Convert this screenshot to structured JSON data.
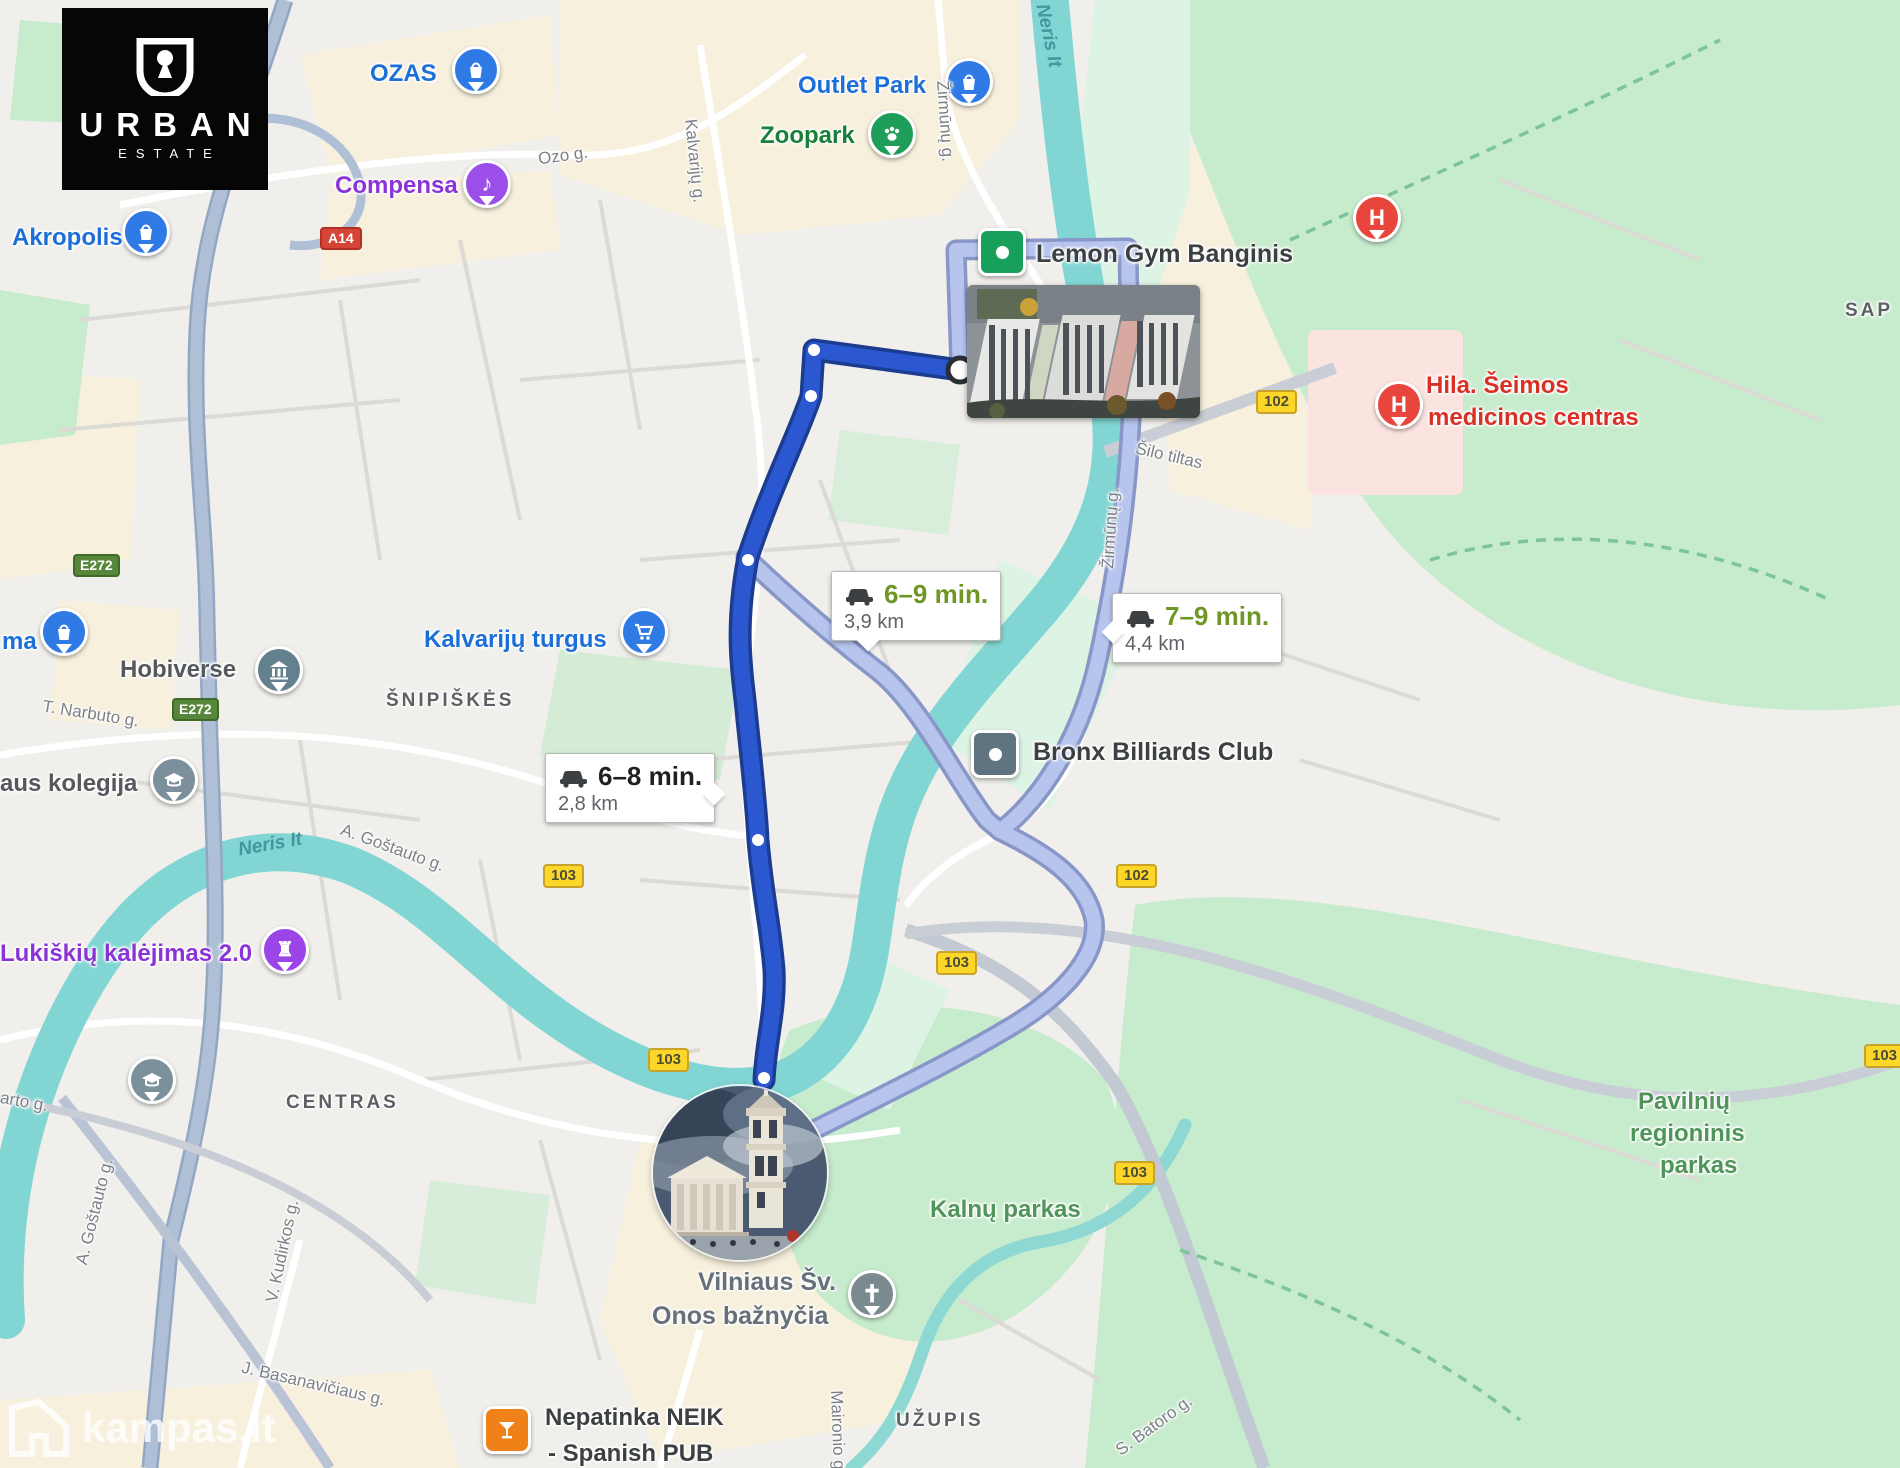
{
  "logo": {
    "brand": "URBAN",
    "sub": "ESTATE"
  },
  "watermark": {
    "text": "kampas.lt"
  },
  "pois": {
    "ozas": {
      "label": "OZAS"
    },
    "outlet": {
      "label": "Outlet Park"
    },
    "zoopark": {
      "label": "Zoopark"
    },
    "compensa": {
      "label": "Compensa"
    },
    "akropolis": {
      "label": "Akropolis"
    },
    "ma": {
      "label": "ma"
    },
    "kalvariju_turgus": {
      "label": "Kalvarijų turgus"
    },
    "hobiverse": {
      "label": "Hobiverse"
    },
    "kolegija": {
      "label": "aus kolegija"
    },
    "lukiskiu": {
      "label": "Lukiškių kalėjimas 2.0"
    },
    "lemon": {
      "label": "Lemon Gym Banginis"
    },
    "bronx": {
      "label": "Bronx Billiards Club"
    },
    "hila": {
      "line1": "Hila. Šeimos",
      "line2": "medicinos centras"
    },
    "onos": {
      "line1": "Vilniaus Šv.",
      "line2": "Onos bažnyčia"
    },
    "pub": {
      "line1": "Nepatinka NEIK",
      "line2": "- Spanish PUB"
    }
  },
  "districts": {
    "snipiskes": "ŠNIPIŠKĖS",
    "centras": "CENTRAS",
    "uzupis": "UŽUPIS",
    "sap": "SAP"
  },
  "parks": {
    "kalnu": "Kalnų parkas",
    "pavilniu1": "Pavilnių",
    "pavilniu2": "regioninis",
    "pavilniu3": "parkas"
  },
  "roads": {
    "ozo": "Ozo g.",
    "kalvariju": "Kalvarijų g.",
    "zirmunu_top": "Žirmūnų g.",
    "zirmunu_mid": "Žirmūnų g.",
    "neris_top": "Neris It",
    "neris_left": "Neris It",
    "silo": "Šilo tiltas",
    "narbuto": "T. Narbuto g.",
    "gostauto_diag": "A. Goštauto g.",
    "gostauto_vert": "A. Goštauto g.",
    "gostauto_frag": "arto g.",
    "kudirkos": "V. Kudirkos g.",
    "basanaviciaus": "J. Basanavičiaus g.",
    "maironio": "Maironio g.",
    "batoro": "S. Batoro g."
  },
  "badges": {
    "a14": "A14",
    "e272a": "E272",
    "e272b": "E272",
    "r102a": "102",
    "r102b": "102",
    "r103a": "103",
    "r103b": "103",
    "r103c": "103",
    "r103d": "103",
    "r103e": "103"
  },
  "bubbles": {
    "fast": {
      "time": "6–8 min.",
      "dist": "2,8 km"
    },
    "alt1": {
      "time": "6–9 min.",
      "dist": "3,9 km"
    },
    "alt2": {
      "time": "7–9 min.",
      "dist": "4,4 km"
    }
  },
  "colors": {
    "route_primary": "#2b57d0",
    "route_primary_casing": "#1b3c8f",
    "route_alt": "#b7c5ee",
    "route_alt_casing": "#8896c8",
    "water": "#81d5d2",
    "park": "#c7ebcd",
    "time_green": "#6f9726",
    "time_dark": "#202124"
  }
}
